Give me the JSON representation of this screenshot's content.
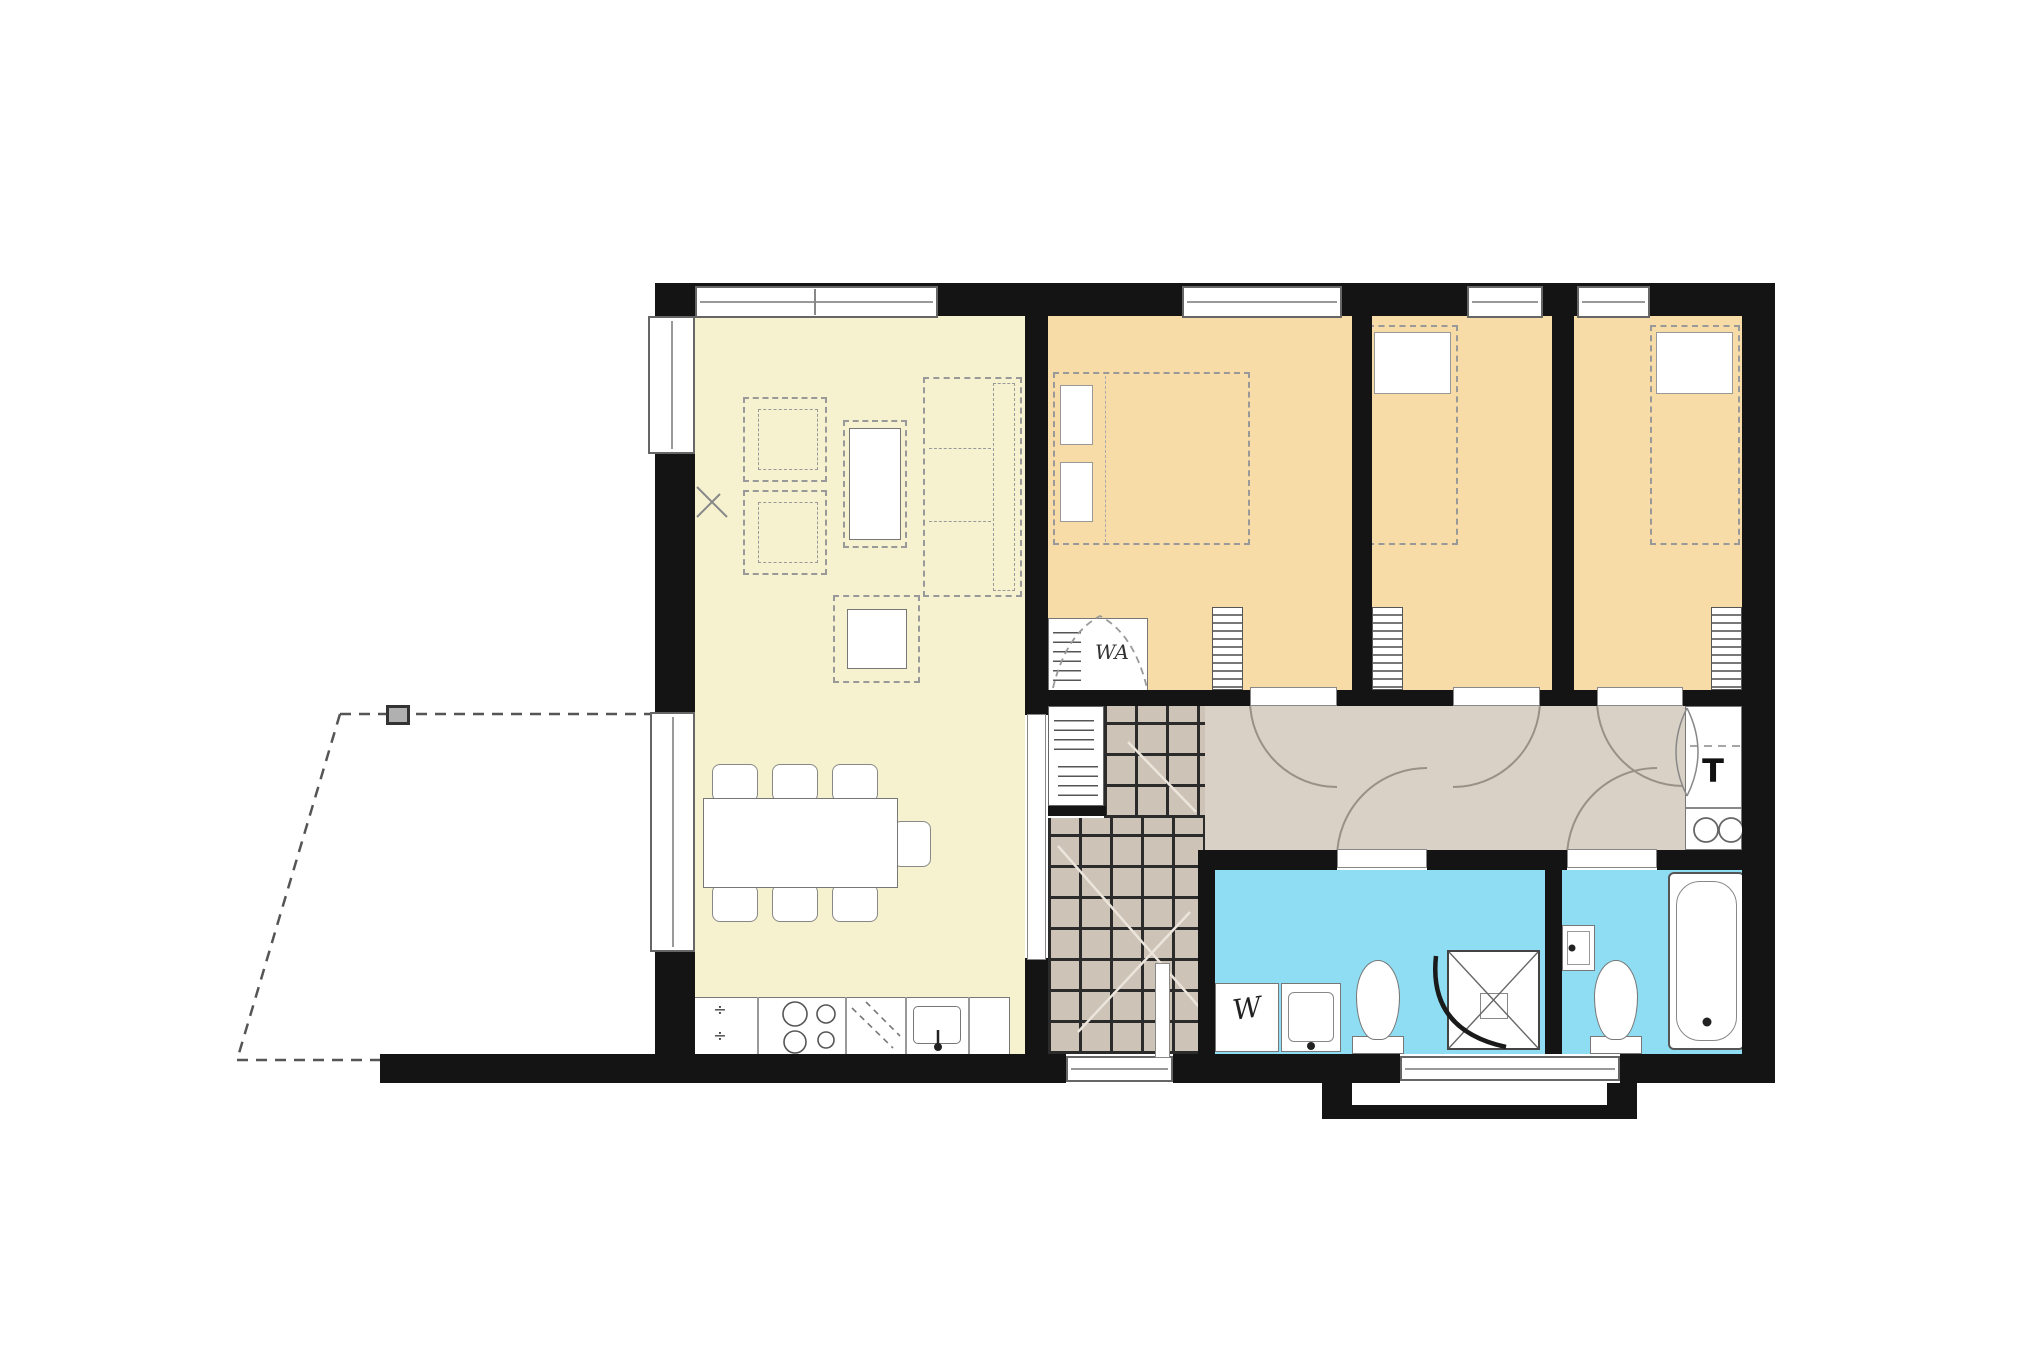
{
  "floorplan": {
    "labels": {
      "wardrobe": "WA",
      "appliance_t": "T",
      "washing_machine": "W",
      "dishwasher_mark": "÷"
    },
    "colors": {
      "wall": "#141414",
      "living": "#F6F2D0",
      "bedroom": "#F8DCA8",
      "hallway": "#D9D1C5",
      "bathroom": "#8EDDF2",
      "tile": "#CDC3B7",
      "tile_line": "#2b2b2b",
      "background": "#FFFFFF"
    }
  }
}
